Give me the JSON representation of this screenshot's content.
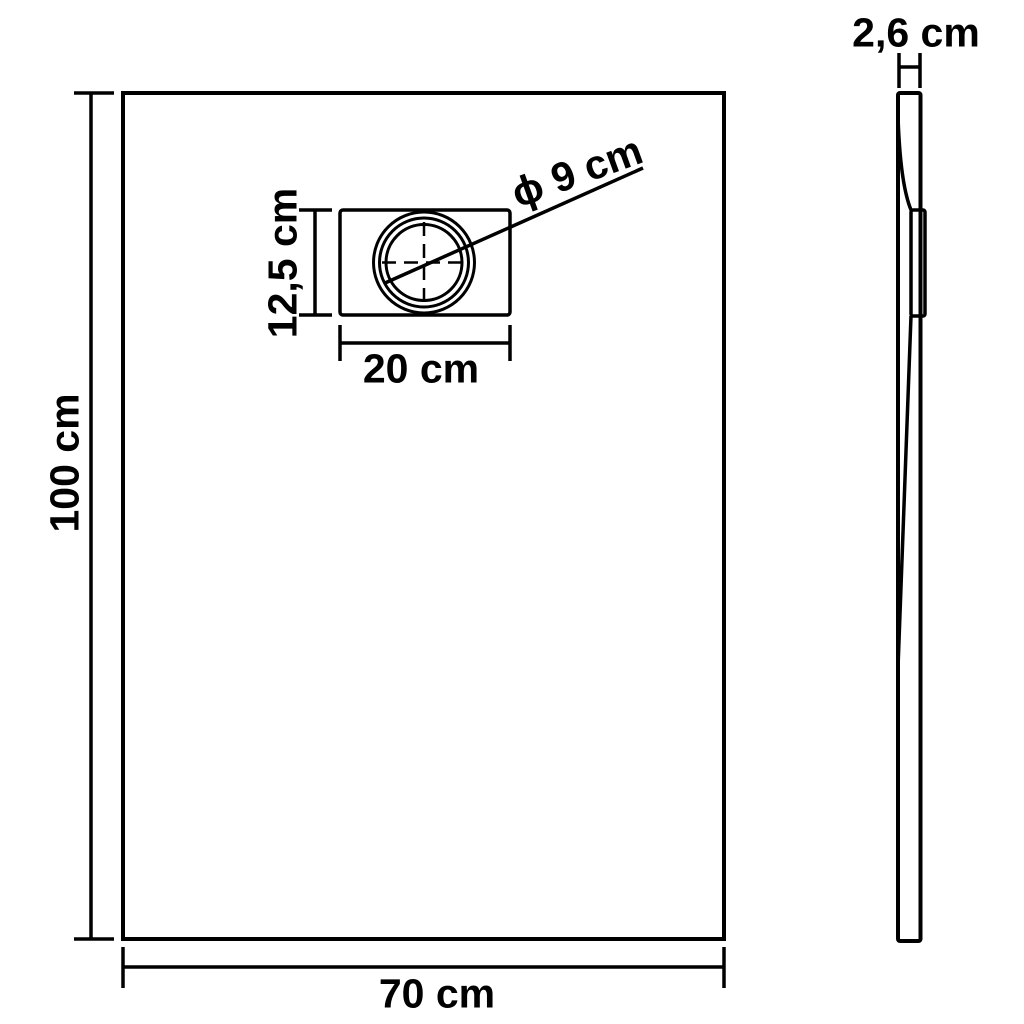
{
  "colors": {
    "line": "#000000",
    "background": "#ffffff"
  },
  "front_view": {
    "height_label": "100 cm",
    "width_label": "70 cm",
    "drain": {
      "height_label": "12,5 cm",
      "width_label": "20 cm",
      "diameter_label": "ϕ 9 cm"
    }
  },
  "side_view": {
    "thickness_label": "2,6 cm"
  }
}
